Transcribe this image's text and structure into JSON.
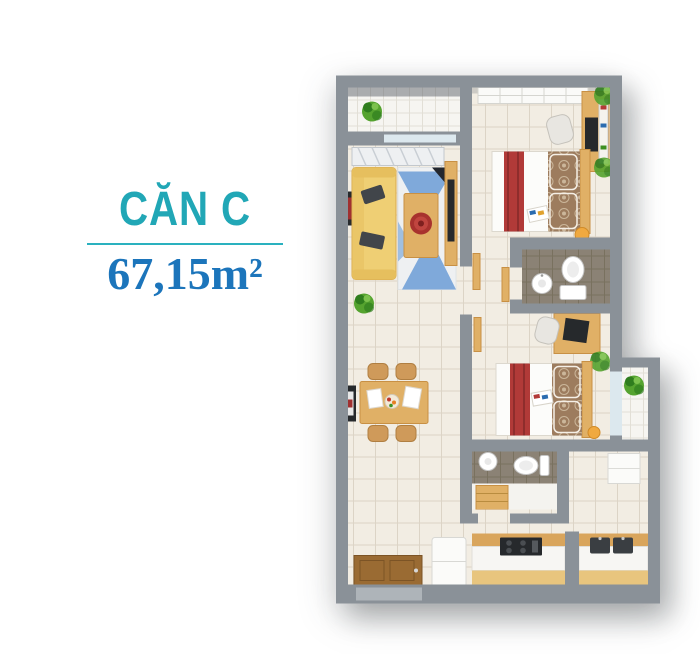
{
  "page": {
    "width": 700,
    "height": 654,
    "background": "#ffffff"
  },
  "panel": {
    "title": "CĂN C",
    "area": "67,15m²",
    "colors": {
      "title": "#21a7b6",
      "divider": "#2ab1bf",
      "area": "#1c75bb"
    }
  },
  "floor_plan": {
    "rooms": [
      "balcony",
      "living-room",
      "dining-area",
      "kitchen",
      "entrance",
      "corridor",
      "bedroom-1",
      "bedroom-2",
      "bathroom-1",
      "bathroom-2",
      "logia"
    ],
    "colors": {
      "wall": "#8a9198",
      "wall_shade": "#5d646b",
      "glass": "#dce8ee",
      "floor": "#f2ede3",
      "floor_grid": "#dcd4c6",
      "balcony_floor": "#f6f5f1",
      "bath_floor": "#8b8275",
      "bath_grid": "#79715f",
      "oak": "#e0b066",
      "oak_dark": "#c89044",
      "door_wood": "#9a6b33",
      "sofa": "#efcf74",
      "pillow": "#41454a",
      "rug_blue": "#7fa9da",
      "rug_navy": "#23272e",
      "red": "#b13a38",
      "red_dark": "#8e2d2c",
      "bed_white": "#fcfcfa",
      "blanket": "#9d7c5e",
      "blanket_light": "#cbb69a",
      "fixture_white": "#ffffff",
      "fixture_stroke": "#c4c4c4",
      "plant": "#55a32f",
      "plant_dark": "#2f7d1e",
      "lamp": "#f0a940",
      "dark": "#26292c",
      "curtain": "#eef0f2",
      "white_goods": "#fbfbf9"
    }
  }
}
